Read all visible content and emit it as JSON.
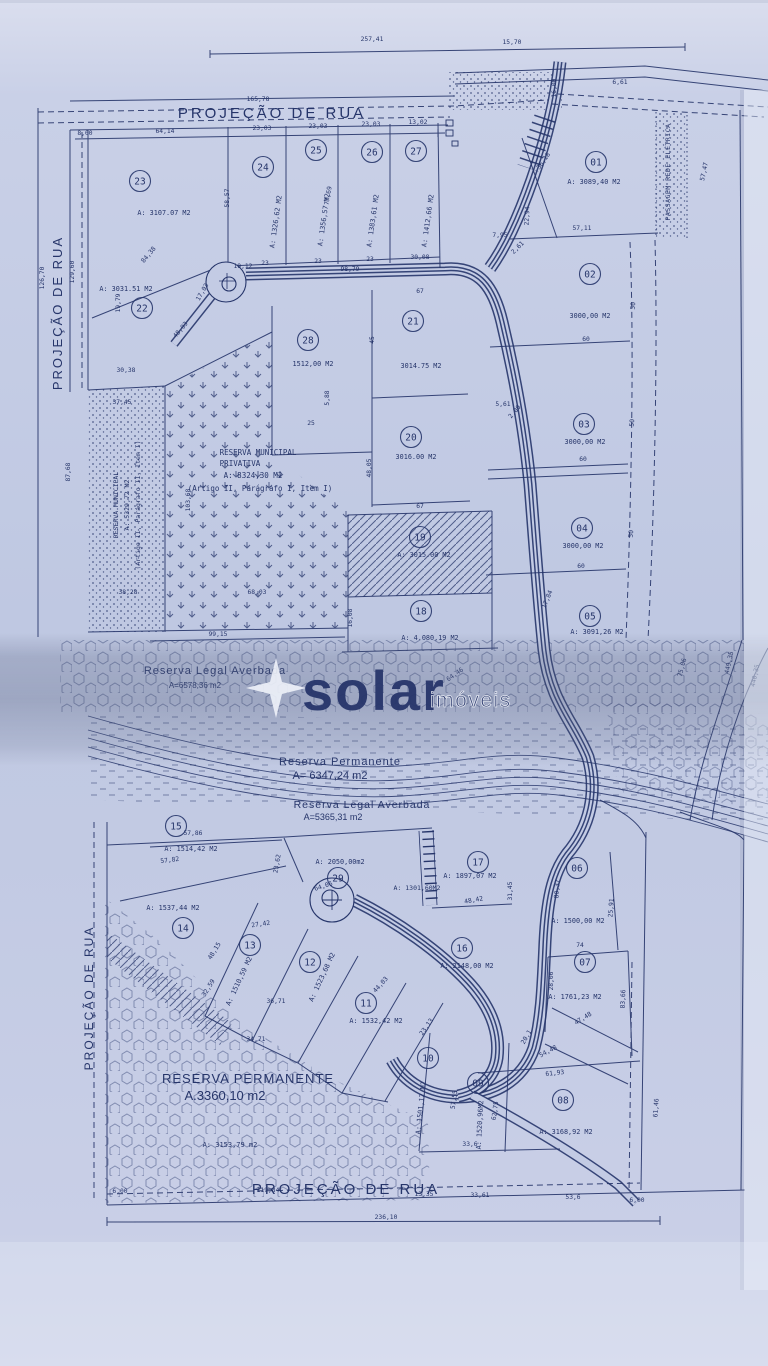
{
  "document": {
    "kind": "scanned land subdivision blueprint"
  },
  "streets": {
    "top": "PROJEÇÃO DE RUA",
    "left_upper": "PROJEÇÃO DE RUA",
    "left_lower": "PROJEÇÃO DE RUA",
    "bottom": "PROJEÇÃO DE RUA",
    "easement": "PASSAGEM REDE ELÉTRICA"
  },
  "watermark": {
    "brand": "solar",
    "suffix": "imóveis"
  },
  "reserves": {
    "municipal_privativa": {
      "l1": "RESERVA MUNICIPAL",
      "l2": "PRIVATIVA",
      "l3": "A: 8324,30 M2",
      "l4": "(Artigo II, Parágrafo I, Item I)"
    },
    "municipal_strip": {
      "l1": "RESERVA MUNICIPAL",
      "l2": "A: 5329,72 M2",
      "l3": "(Artigo II, Parágrafo II, Item I)"
    },
    "legal_averbada_1": {
      "l1": "Reserva Legal Averbada",
      "l2": "A=6578,36 m2"
    },
    "permanente_1": {
      "l1": "Reserva Permanente",
      "l2": "A=  6347,24  m2"
    },
    "legal_averbada_2": {
      "l1": "Reserva Legal Averbada",
      "l2": "A=5365,31 m2"
    },
    "permanente_2": {
      "l1": "RESERVA PERMANENTE",
      "l2": "A.3360,10  m2"
    },
    "area_extra": "A: 3153,79 m2",
    "area_strip_lot": "A: 1301,60M2"
  },
  "lots": [
    {
      "n": "01",
      "a": "A: 3089,40 M2",
      "x": 596,
      "y": 162,
      "ax": 594,
      "ay": 184,
      "ar": 0
    },
    {
      "n": "02",
      "a": "3000,00 M2",
      "x": 590,
      "y": 274,
      "ax": 590,
      "ay": 318,
      "ar": 0
    },
    {
      "n": "03",
      "a": "3000,00 M2",
      "x": 584,
      "y": 424,
      "ax": 585,
      "ay": 444,
      "ar": 0
    },
    {
      "n": "04",
      "a": "3000,00 M2",
      "x": 582,
      "y": 528,
      "ax": 583,
      "ay": 548,
      "ar": 0
    },
    {
      "n": "05",
      "a": "A: 3091,26 M2",
      "x": 590,
      "y": 616,
      "ax": 597,
      "ay": 634,
      "ar": 0
    },
    {
      "n": "06",
      "a": "A: 1500,00 M2",
      "x": 577,
      "y": 868,
      "ax": 578,
      "ay": 923,
      "ar": 0
    },
    {
      "n": "07",
      "a": "A: 1761,23 M2",
      "x": 585,
      "y": 962,
      "ax": 575,
      "ay": 999,
      "ar": 0
    },
    {
      "n": "08",
      "a": "A: 3168,92 M2",
      "x": 563,
      "y": 1100,
      "ax": 566,
      "ay": 1134,
      "ar": 0
    },
    {
      "n": "09",
      "a": "A: 1520,96M2",
      "x": 478,
      "y": 1083,
      "ax": 482,
      "ay": 1125,
      "ar": -87
    },
    {
      "n": "10",
      "a": "A: 1501,12 M2",
      "x": 428,
      "y": 1058,
      "ax": 423,
      "ay": 1108,
      "ar": -84
    },
    {
      "n": "11",
      "a": "A: 1532,42 M2",
      "x": 366,
      "y": 1003,
      "ax": 376,
      "ay": 1023,
      "ar": 0
    },
    {
      "n": "12",
      "a": "A: 1523,68 M2",
      "x": 310,
      "y": 962,
      "ax": 324,
      "ay": 978,
      "ar": -65
    },
    {
      "n": "13",
      "a": "A: 1510,59 M2",
      "x": 250,
      "y": 945,
      "ax": 241,
      "ay": 982,
      "ar": -65
    },
    {
      "n": "14",
      "a": "A: 1537,44 M2",
      "x": 183,
      "y": 928,
      "ax": 173,
      "ay": 910,
      "ar": 0
    },
    {
      "n": "15",
      "a": "A: 1514,42 M2",
      "x": 176,
      "y": 826,
      "ax": 191,
      "ay": 851,
      "ar": 0
    },
    {
      "n": "16",
      "a": "A: 2148,00 M2",
      "x": 462,
      "y": 948,
      "ax": 467,
      "ay": 968,
      "ar": 0
    },
    {
      "n": "17",
      "a": "A: 1897,07 M2",
      "x": 478,
      "y": 862,
      "ax": 470,
      "ay": 878,
      "ar": 0
    },
    {
      "n": "18",
      "a": "A: 4.080,19 M2",
      "x": 421,
      "y": 611,
      "ax": 430,
      "ay": 640,
      "ar": 0
    },
    {
      "n": "19",
      "a": "A: 3015.00 M2",
      "x": 420,
      "y": 537,
      "ax": 424,
      "ay": 557,
      "ar": 0
    },
    {
      "n": "20",
      "a": "3016.00 M2",
      "x": 411,
      "y": 437,
      "ax": 416,
      "ay": 459,
      "ar": 0
    },
    {
      "n": "21",
      "a": "3014.75 M2",
      "x": 413,
      "y": 321,
      "ax": 421,
      "ay": 368,
      "ar": 0
    },
    {
      "n": "22",
      "a": "A: 3031.51 M2",
      "x": 142,
      "y": 308,
      "ax": 126,
      "ay": 291,
      "ar": 0
    },
    {
      "n": "23",
      "a": "A: 3107.07 M2",
      "x": 140,
      "y": 181,
      "ax": 164,
      "ay": 215,
      "ar": 0
    },
    {
      "n": "24",
      "a": "A: 1326,62 M2",
      "x": 263,
      "y": 167,
      "ax": 278,
      "ay": 222,
      "ar": -82
    },
    {
      "n": "25",
      "a": "A: 1356,57 M2",
      "x": 316,
      "y": 150,
      "ax": 326,
      "ay": 220,
      "ar": -82
    },
    {
      "n": "26",
      "a": "A: 1383,61 M2",
      "x": 372,
      "y": 152,
      "ax": 375,
      "ay": 221,
      "ar": -82
    },
    {
      "n": "27",
      "a": "A: 1412,66 M2",
      "x": 416,
      "y": 151,
      "ax": 430,
      "ay": 221,
      "ar": -82
    },
    {
      "n": "28",
      "a": "1512,00 M2",
      "x": 308,
      "y": 340,
      "ax": 313,
      "ay": 366,
      "ar": 0
    },
    {
      "n": "29",
      "a": "A: 2050,00m2",
      "x": 338,
      "y": 878,
      "ax": 340,
      "ay": 864,
      "ar": 0
    }
  ],
  "dimensions": [
    {
      "t": "257,41",
      "x": 372,
      "y": 41
    },
    {
      "t": "15,70",
      "x": 512,
      "y": 44
    },
    {
      "t": "165,78",
      "x": 258,
      "y": 101
    },
    {
      "t": "6,61",
      "x": 620,
      "y": 84
    },
    {
      "t": "16,00",
      "x": 556,
      "y": 88,
      "r": -90
    },
    {
      "t": "8,00",
      "x": 85,
      "y": 135
    },
    {
      "t": "64,14",
      "x": 165,
      "y": 133
    },
    {
      "t": "23,03",
      "x": 262,
      "y": 130
    },
    {
      "t": "23,03",
      "x": 318,
      "y": 128
    },
    {
      "t": "23,03",
      "x": 371,
      "y": 126
    },
    {
      "t": "13,02",
      "x": 418,
      "y": 124
    },
    {
      "t": "126,70",
      "x": 44,
      "y": 278,
      "r": -90
    },
    {
      "t": "129,60",
      "x": 74,
      "y": 272,
      "r": -90
    },
    {
      "t": "58,57",
      "x": 229,
      "y": 198,
      "r": -90
    },
    {
      "t": "77,69",
      "x": 330,
      "y": 196,
      "r": -80
    },
    {
      "t": "84,38",
      "x": 150,
      "y": 256,
      "r": -50
    },
    {
      "t": "19,12",
      "x": 243,
      "y": 268
    },
    {
      "t": "23",
      "x": 265,
      "y": 265
    },
    {
      "t": "23",
      "x": 318,
      "y": 263
    },
    {
      "t": "23",
      "x": 370,
      "y": 261
    },
    {
      "t": "30,08",
      "x": 420,
      "y": 259
    },
    {
      "t": "19,79",
      "x": 120,
      "y": 303,
      "r": -90
    },
    {
      "t": "17,03",
      "x": 204,
      "y": 293,
      "r": -60
    },
    {
      "t": "48,93",
      "x": 182,
      "y": 331,
      "r": -50
    },
    {
      "t": "98,79",
      "x": 350,
      "y": 271
    },
    {
      "t": "30,38",
      "x": 126,
      "y": 372
    },
    {
      "t": "37,45",
      "x": 122,
      "y": 404
    },
    {
      "t": "87,68",
      "x": 70,
      "y": 472,
      "r": -90
    },
    {
      "t": "103,68",
      "x": 190,
      "y": 500,
      "r": -90
    },
    {
      "t": "38,28",
      "x": 128,
      "y": 594
    },
    {
      "t": "99,15",
      "x": 218,
      "y": 636
    },
    {
      "t": "68,03",
      "x": 257,
      "y": 594
    },
    {
      "t": "67",
      "x": 420,
      "y": 293
    },
    {
      "t": "45",
      "x": 374,
      "y": 340,
      "r": -90
    },
    {
      "t": "25",
      "x": 311,
      "y": 425
    },
    {
      "t": "5,88",
      "x": 329,
      "y": 398,
      "r": -90
    },
    {
      "t": "48,05",
      "x": 371,
      "y": 468,
      "r": -90
    },
    {
      "t": "67",
      "x": 420,
      "y": 508
    },
    {
      "t": "16,08",
      "x": 352,
      "y": 618,
      "r": -90
    },
    {
      "t": "64,46",
      "x": 456,
      "y": 676,
      "r": -35
    },
    {
      "t": "36,18",
      "x": 545,
      "y": 162,
      "r": -55
    },
    {
      "t": "22,94",
      "x": 529,
      "y": 216,
      "r": -88
    },
    {
      "t": "7,95",
      "x": 500,
      "y": 237
    },
    {
      "t": "2,61",
      "x": 519,
      "y": 249,
      "r": -45
    },
    {
      "t": "57,11",
      "x": 582,
      "y": 230
    },
    {
      "t": "57,47",
      "x": 706,
      "y": 172,
      "r": -78
    },
    {
      "t": "5,61",
      "x": 503,
      "y": 406
    },
    {
      "t": "2,00",
      "x": 516,
      "y": 413,
      "r": -50
    },
    {
      "t": "60",
      "x": 586,
      "y": 341
    },
    {
      "t": "50",
      "x": 635,
      "y": 306,
      "r": -85
    },
    {
      "t": "60",
      "x": 583,
      "y": 461
    },
    {
      "t": "50",
      "x": 634,
      "y": 423,
      "r": -85
    },
    {
      "t": "60",
      "x": 581,
      "y": 568
    },
    {
      "t": "50",
      "x": 633,
      "y": 534,
      "r": -85
    },
    {
      "t": "17,84",
      "x": 549,
      "y": 600,
      "r": -68
    },
    {
      "t": "75,06",
      "x": 684,
      "y": 668,
      "r": -75
    },
    {
      "t": "449,35",
      "x": 731,
      "y": 663,
      "r": -78
    },
    {
      "t": "440,35",
      "x": 757,
      "y": 676,
      "r": -78
    },
    {
      "t": "57,86",
      "x": 193,
      "y": 835
    },
    {
      "t": "57,82",
      "x": 170,
      "y": 862,
      "r": -7
    },
    {
      "t": "23,62",
      "x": 279,
      "y": 864,
      "r": -80
    },
    {
      "t": "64,06",
      "x": 324,
      "y": 888,
      "r": -18
    },
    {
      "t": "27,42",
      "x": 261,
      "y": 926,
      "r": -8
    },
    {
      "t": "48,15",
      "x": 216,
      "y": 952,
      "r": -58
    },
    {
      "t": "32,59",
      "x": 210,
      "y": 989,
      "r": -58
    },
    {
      "t": "36,71",
      "x": 276,
      "y": 1003
    },
    {
      "t": "44,03",
      "x": 382,
      "y": 986,
      "r": -48
    },
    {
      "t": "34,71",
      "x": 256,
      "y": 1041
    },
    {
      "t": "23,13",
      "x": 428,
      "y": 1028,
      "r": -55
    },
    {
      "t": "31,45",
      "x": 512,
      "y": 891,
      "r": -90
    },
    {
      "t": "48,42",
      "x": 474,
      "y": 902,
      "r": -10
    },
    {
      "t": "80,37",
      "x": 559,
      "y": 889,
      "r": -86
    },
    {
      "t": "25,91",
      "x": 613,
      "y": 908,
      "r": -86
    },
    {
      "t": "74",
      "x": 580,
      "y": 947
    },
    {
      "t": "28,06",
      "x": 553,
      "y": 981,
      "r": -90
    },
    {
      "t": "83,66",
      "x": 625,
      "y": 999,
      "r": -88
    },
    {
      "t": "47,48",
      "x": 584,
      "y": 1020,
      "r": -32
    },
    {
      "t": "54,48",
      "x": 549,
      "y": 1053,
      "r": -28
    },
    {
      "t": "61,93",
      "x": 555,
      "y": 1075,
      "r": -6
    },
    {
      "t": "20,1",
      "x": 528,
      "y": 1038,
      "r": -60
    },
    {
      "t": "57,55",
      "x": 456,
      "y": 1100,
      "r": -82
    },
    {
      "t": "62,75",
      "x": 497,
      "y": 1111,
      "r": -82
    },
    {
      "t": "33,6",
      "x": 470,
      "y": 1146
    },
    {
      "t": "61,46",
      "x": 658,
      "y": 1108,
      "r": -86
    },
    {
      "t": "6,00",
      "x": 120,
      "y": 1193
    },
    {
      "t": "119,84",
      "x": 268,
      "y": 1192
    },
    {
      "t": "13,35",
      "x": 424,
      "y": 1196
    },
    {
      "t": "33,61",
      "x": 480,
      "y": 1197
    },
    {
      "t": "53,6",
      "x": 573,
      "y": 1199
    },
    {
      "t": "6,00",
      "x": 637,
      "y": 1202
    },
    {
      "t": "236,10",
      "x": 386,
      "y": 1219
    }
  ]
}
